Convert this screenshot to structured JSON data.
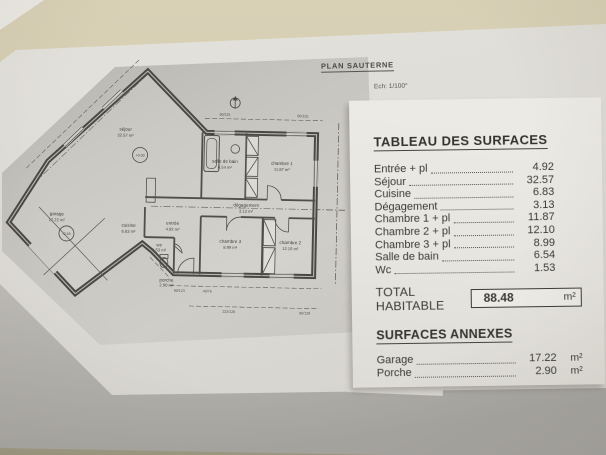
{
  "photo": {
    "plan_sheet": {
      "title": "PLAN SAUTERNE",
      "scale_label": "Ech: 1/100°"
    },
    "floor_plan": {
      "rooms": [
        {
          "name": "séjour",
          "area": "32.57 m²"
        },
        {
          "name": "cuisine",
          "area": "6.83 m²"
        },
        {
          "name": "garage",
          "area": "17.22 m²"
        },
        {
          "name": "entrée",
          "area": "4.92 m²"
        },
        {
          "name": "wc",
          "area": "1.53 m²"
        },
        {
          "name": "porche",
          "area": "2.90 m²"
        },
        {
          "name": "dégagement",
          "area": "3.13 m²"
        },
        {
          "name": "salle de bain",
          "area": "6.54 m²"
        },
        {
          "name": "chambre 1",
          "area": "11.87 m²"
        },
        {
          "name": "chambre 2",
          "area": "12.10 m²"
        },
        {
          "name": "chambre 3",
          "area": "8.99 m²"
        }
      ],
      "level_markers": [
        {
          "label": "+0.00"
        },
        {
          "label": "-0.18"
        }
      ],
      "dimension_labels": [
        "90/125",
        "80/125",
        "90/123",
        "40/75",
        "222/128",
        "80/128"
      ]
    },
    "surface_table": {
      "title": "TABLEAU DES SURFACES",
      "rows": [
        {
          "label": "Entrée + pl",
          "value": "4.92"
        },
        {
          "label": "Séjour",
          "value": "32.57"
        },
        {
          "label": "Cuisine",
          "value": "6.83"
        },
        {
          "label": "Dégagement",
          "value": "3.13"
        },
        {
          "label": "Chambre 1 + pl",
          "value": "11.87"
        },
        {
          "label": "Chambre 2 + pl",
          "value": "12.10"
        },
        {
          "label": "Chambre 3 + pl",
          "value": "8.99"
        },
        {
          "label": "Salle de bain",
          "value": "6.54"
        },
        {
          "label": "Wc",
          "value": "1.53"
        }
      ],
      "total": {
        "label": "TOTAL HABITABLE",
        "value": "88.48",
        "unit": "m²"
      },
      "annexes_title": "SURFACES ANNEXES",
      "annex_rows": [
        {
          "label": "Garage",
          "value": "17.22",
          "unit": "m²"
        },
        {
          "label": "Porche",
          "value": "2.90",
          "unit": "m²"
        }
      ]
    }
  }
}
